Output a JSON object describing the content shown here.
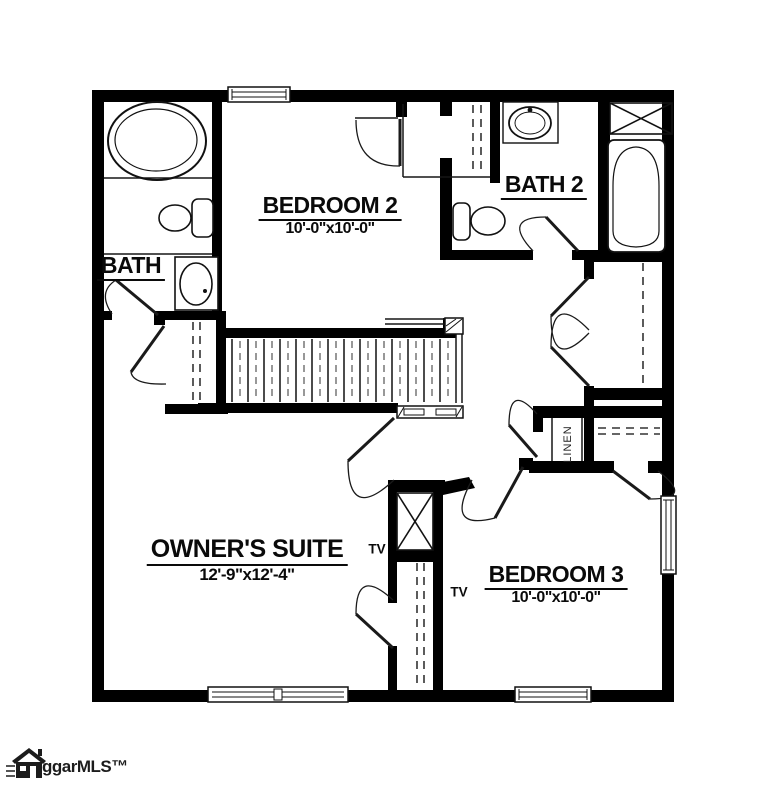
{
  "plan": {
    "labels": {
      "bedroom2": {
        "name": "BEDROOM 2",
        "dims": "10'-0\"x10'-0\""
      },
      "bath": {
        "name": "BATH"
      },
      "bath2": {
        "name": "BATH 2"
      },
      "owners": {
        "name": "OWNER'S SUITE",
        "dims": "12'-9\"x12'-4\""
      },
      "bedroom3": {
        "name": "BEDROOM 3",
        "dims": "10'-0\"x10'-0\""
      },
      "tv": "TV",
      "linen": "LINEN"
    },
    "watermark": {
      "text": "ggarMLS™"
    },
    "colors": {
      "wall": "#000000",
      "line": "#1a1a1a",
      "bg": "#ffffff"
    }
  }
}
